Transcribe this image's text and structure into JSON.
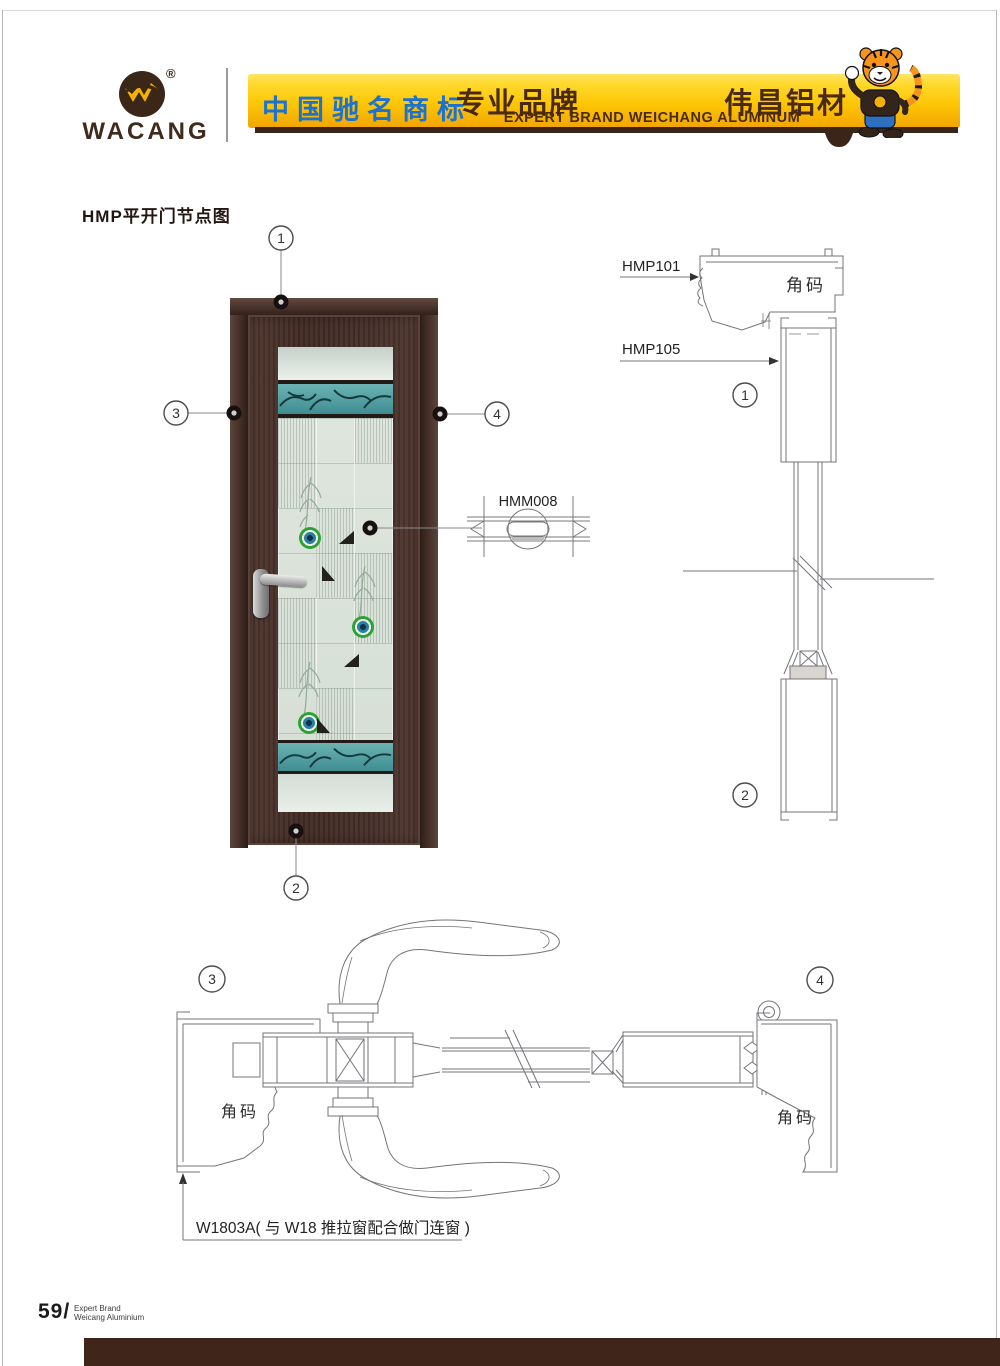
{
  "header": {
    "logo": {
      "brand": "WACANG",
      "registered": "®"
    },
    "banner": {
      "cn_trademark": "中国驰名商标",
      "brand_zh_left": "专业品牌",
      "brand_zh_right": "伟昌铝材",
      "brand_en": "EXPERT BRAND WEICHANG ALUMINUM"
    },
    "mascot": "tiger-mascot"
  },
  "content": {
    "title": "HMP平开门节点图"
  },
  "labels": {
    "hmp101": "HMP101",
    "hmp105": "HMP105",
    "hmm008": "HMM008",
    "corner_code": "角码",
    "note_w1803a": "W1803A( 与 W18 推拉窗配合做门连窗 )"
  },
  "callouts": {
    "c1": "1",
    "c2": "2",
    "c3": "3",
    "c4": "4"
  },
  "footer": {
    "page_number": "59/",
    "brand_line1": "Expert Brand",
    "brand_line2": "Weicang Aluminium"
  },
  "colors": {
    "gold_top": "#ffe566",
    "gold_deep": "#f2a500",
    "banner_blue": "#1b72cf",
    "banner_brown": "#4a2a10",
    "shadow_brown": "#3b2418",
    "footer_bar": "#40261a",
    "logo_brown": "#3f2a1d",
    "teal_glass": "#4f9da0",
    "drawing_line": "#77787a"
  }
}
